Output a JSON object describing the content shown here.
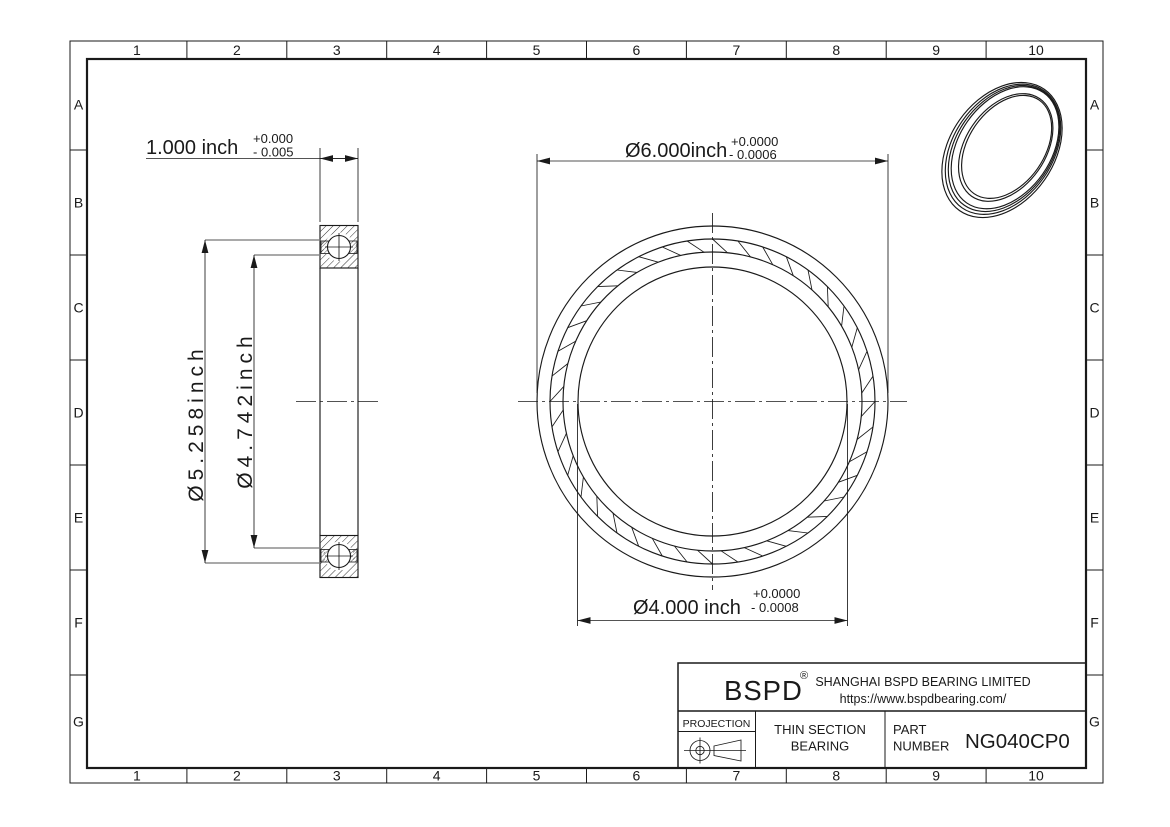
{
  "drawing": {
    "colors": {
      "line": "#1a1a1a",
      "background": "#ffffff"
    },
    "grid": {
      "columns": [
        "1",
        "2",
        "3",
        "4",
        "5",
        "6",
        "7",
        "8",
        "9",
        "10"
      ],
      "rows": [
        "A",
        "B",
        "C",
        "D",
        "E",
        "F",
        "G"
      ]
    },
    "section_view": {
      "width_dim": {
        "value": "1.000 inch",
        "tol_plus": "+0.000",
        "tol_minus": "- 0.005"
      },
      "outer_race_dim": "Ø5.258inch",
      "inner_race_dim": "Ø4.742inch"
    },
    "front_view": {
      "outer_dia_dim": {
        "value": "Ø6.000inch",
        "tol_plus": "+0.0000",
        "tol_minus": "- 0.0006"
      },
      "bore_dia_dim": {
        "value": "Ø4.000 inch",
        "tol_plus": "+0.0000",
        "tol_minus": "- 0.0008"
      }
    },
    "title_block": {
      "brand": "BSPD",
      "registered_mark": "®",
      "company": "SHANGHAI BSPD BEARING LIMITED",
      "website": "https://www.bspdbearing.com/",
      "projection_label": "PROJECTION",
      "product_type_line1": "THIN SECTION",
      "product_type_line2": "BEARING",
      "part_label_line1": "PART",
      "part_label_line2": "NUMBER",
      "part_number": "NG040CP0"
    }
  }
}
